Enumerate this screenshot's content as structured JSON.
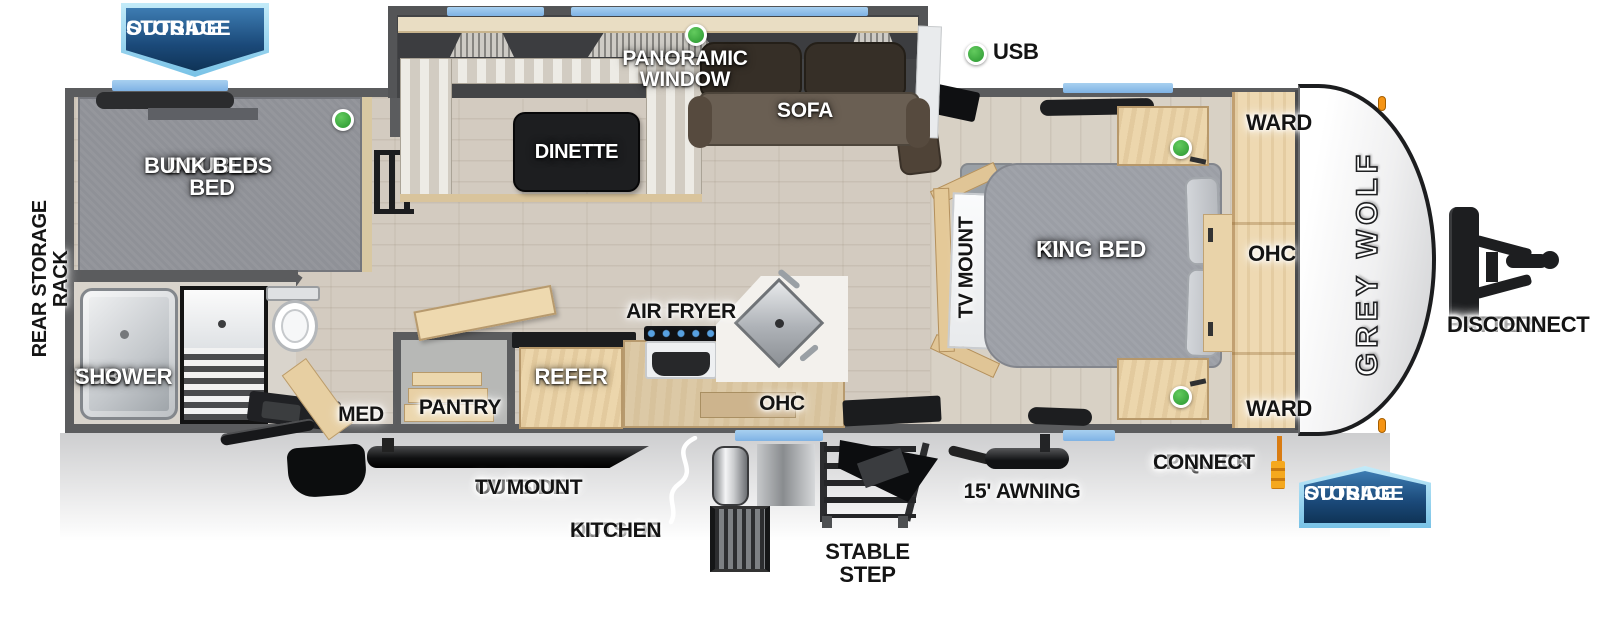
{
  "title": "Grey Wolf travel trailer floor plan",
  "brand": {
    "name": "GREY WOLF"
  },
  "badges": {
    "outside_storage_top": {
      "l1": "OUTSIDE",
      "l2": "STORAGE"
    },
    "outside_storage_bottom": {
      "l1": "OUTSIDE",
      "l2": "STORAGE"
    }
  },
  "labels": {
    "panoramic_window": "PANORAMIC WINDOW",
    "sofa": "SOFA",
    "dinette": "DINETTE",
    "usb": "USB",
    "double_bed_bunk": {
      "l1": "DOUBLE BED",
      "l2": "BUNK BEDS"
    },
    "rear_storage_rack": "REAR STORAGE RACK",
    "tub_shower": {
      "l1": "TUB /",
      "l2": "SHOWER"
    },
    "med": "MED",
    "pantry": "PANTRY",
    "refer": "REFER",
    "air_fryer": "AIR FRYER",
    "ohc_kitchen": "OHC",
    "tv_mount": "TV MOUNT",
    "rv_king_bed": {
      "l1": "RV",
      "l2": "KING BED"
    },
    "ward_top": "WARD",
    "ohc_bedroom": "OHC",
    "ward_bottom": "WARD",
    "battery_disconnect": {
      "l1": "BATTERY",
      "l2": "DISCONNECT"
    },
    "lp_quick_connect": {
      "l1": "LP QUICK",
      "l2": "CONNECT"
    },
    "outside_tv_mount": {
      "l1": "OUTSIDE",
      "l2": "TV MOUNT"
    },
    "outside_kitchen": {
      "l1": "OUTSIDE",
      "l2": "KITCHEN"
    },
    "stable_step": "STABLE STEP",
    "awning": "15' AWNING"
  },
  "colors": {
    "banner_blue_dark": "#1b4a7a",
    "banner_blue_border": "#79c2e6",
    "window_blue": "#7fb2e4",
    "usb_green": "#37a33b",
    "marker_orange": "#f59414",
    "wall_gray": "#5b5c5e",
    "wood": "#ecd6ac",
    "sofa_brown": "#6a5f53",
    "mattress_gray": "#9b9ea5"
  }
}
